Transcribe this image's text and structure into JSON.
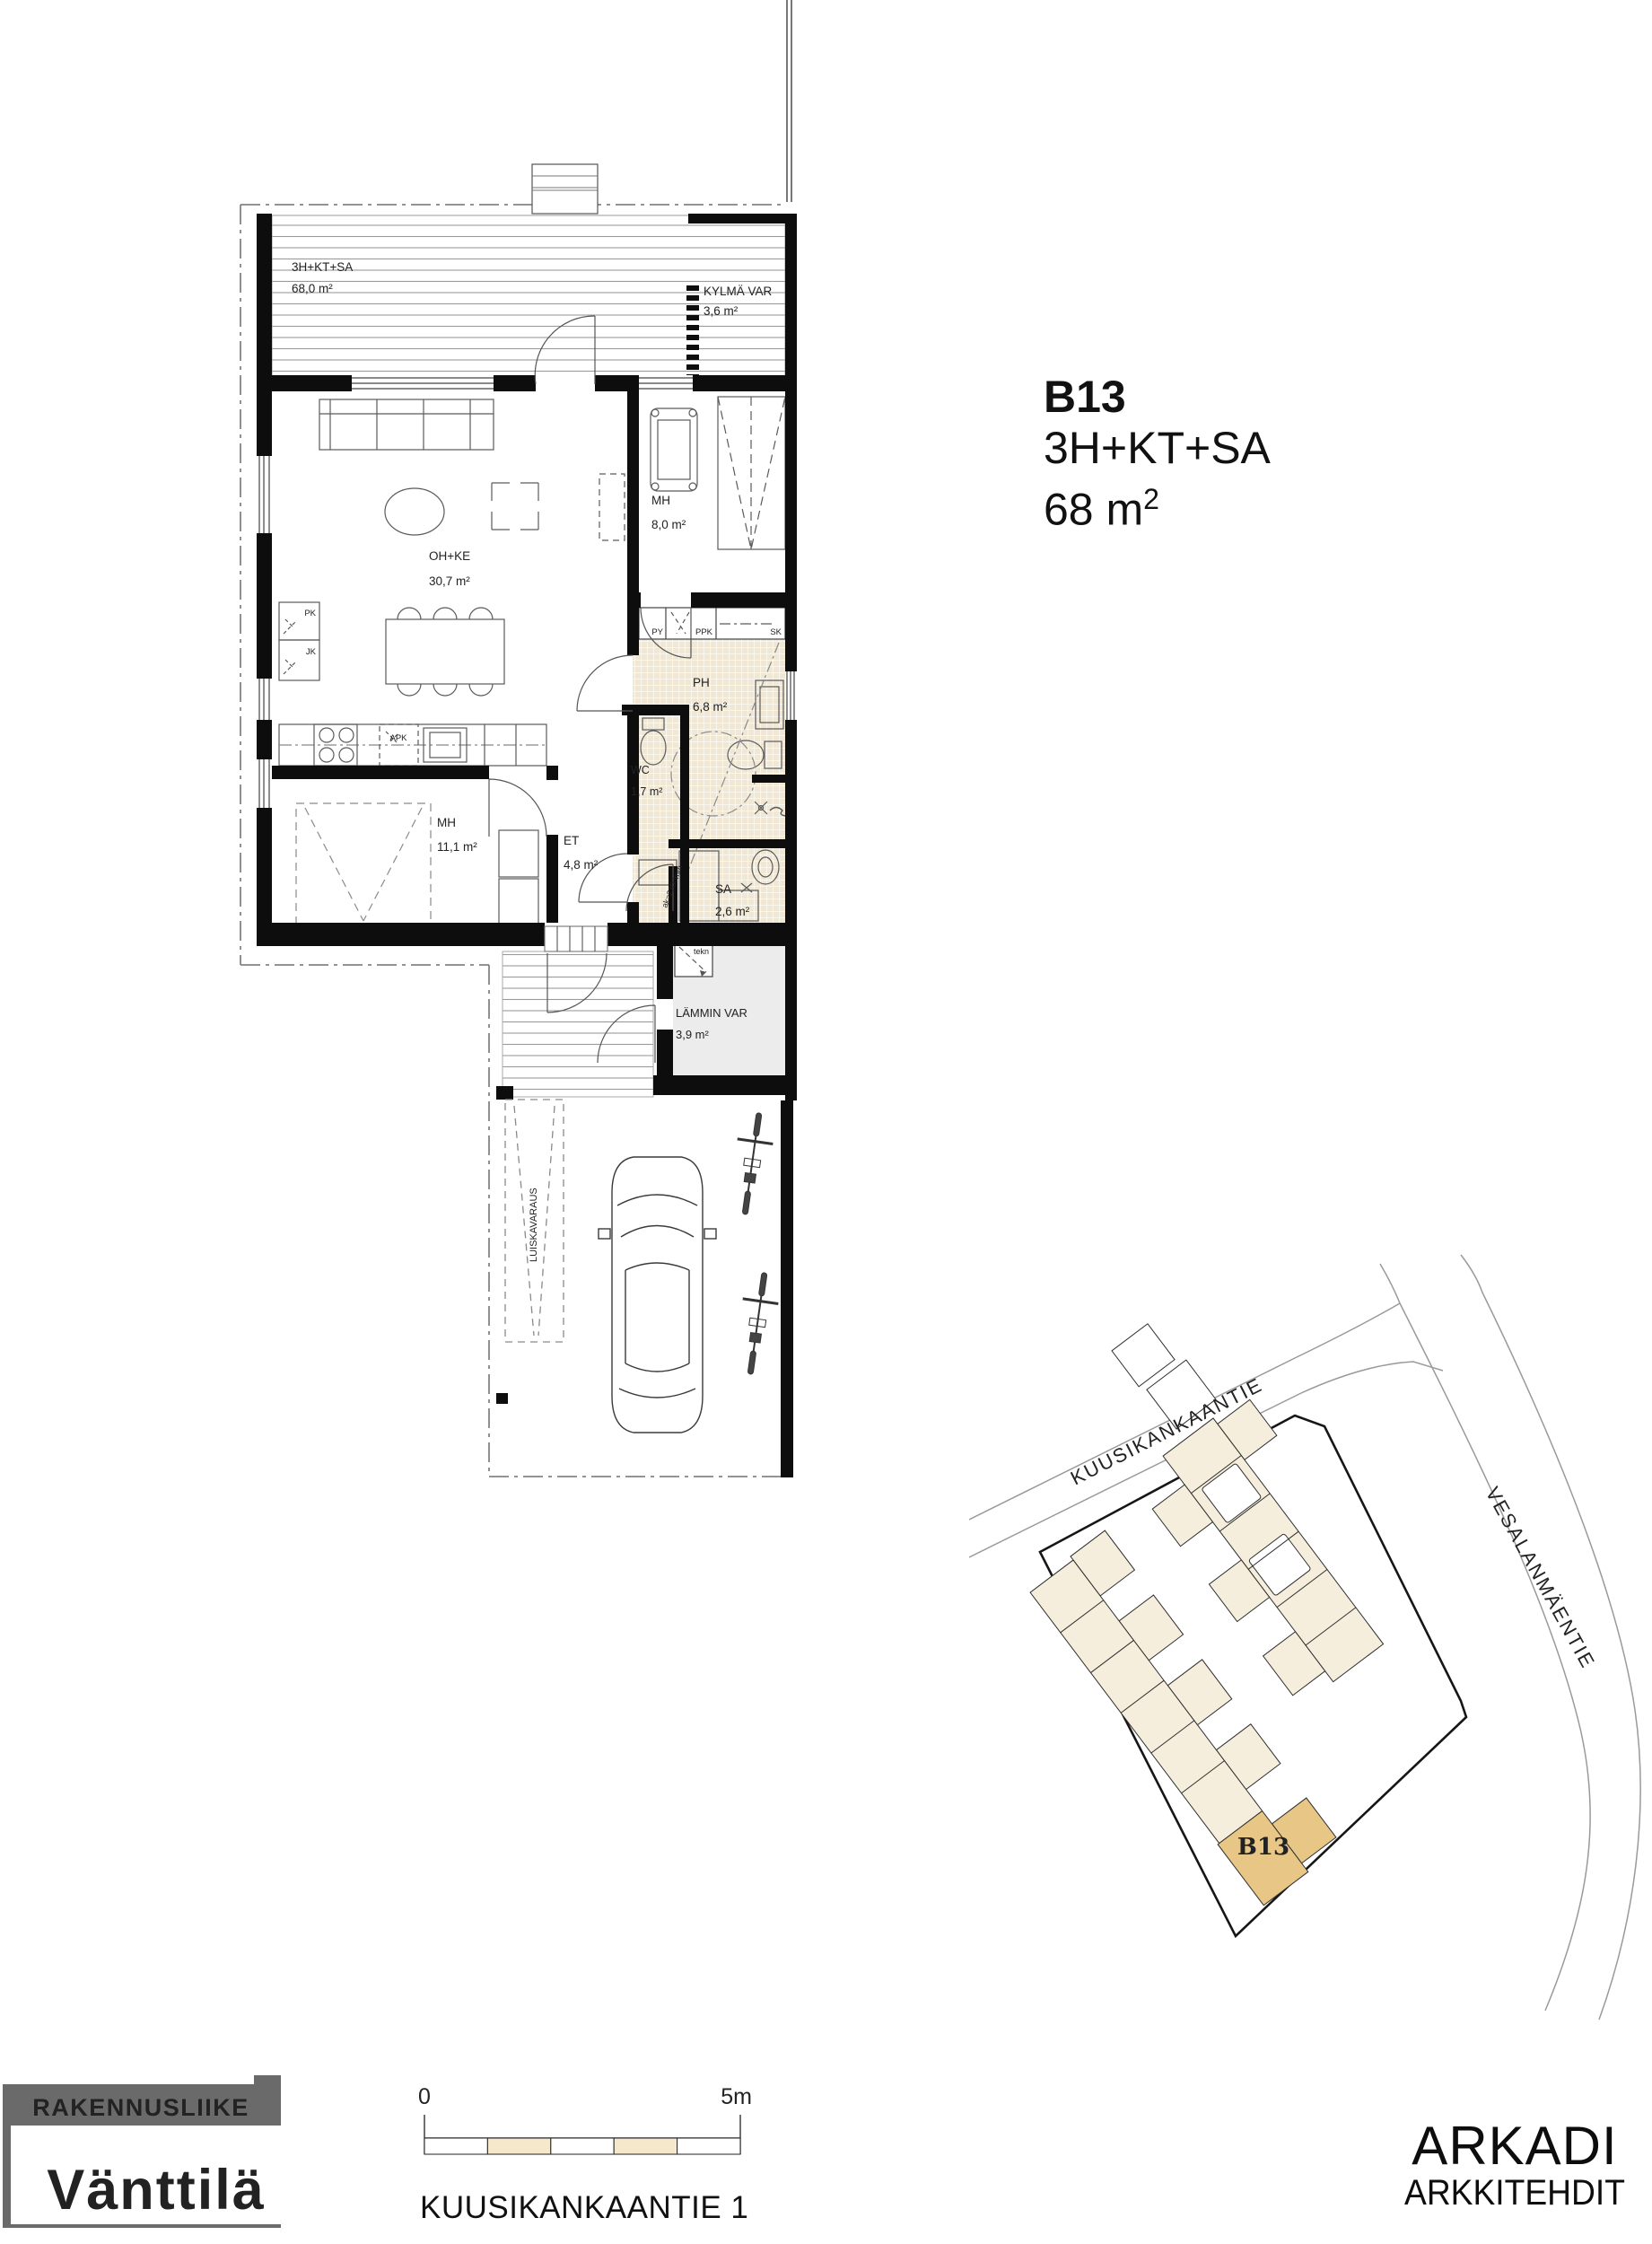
{
  "title": {
    "unit": "B13",
    "type": "3H+KT+SA",
    "area_value": "68 m",
    "area_sup": "2"
  },
  "floor_plan": {
    "terrace": {
      "type": "3H+KT+SA",
      "area": "68,0 m²"
    },
    "kylma_var": {
      "name": "KYLMÄ VAR",
      "area": "3,6 m²"
    },
    "oh_ke": {
      "name": "OH+KE",
      "area": "30,7 m²"
    },
    "mh1": {
      "name": "MH",
      "area": "8,0 m²"
    },
    "ph": {
      "name": "PH",
      "area": "6,8 m²"
    },
    "wc": {
      "name": "WC",
      "area": "1,7 m²"
    },
    "mh2": {
      "name": "MH",
      "area": "11,1 m²"
    },
    "et": {
      "name": "ET",
      "area": "4,8 m²"
    },
    "sa": {
      "name": "SA",
      "area": "2,6 m²"
    },
    "lammin_var": {
      "name": "LÄMMIN VAR",
      "area": "3,9 m²"
    },
    "small_labels": {
      "py": "PY",
      "ppk": "PPK",
      "sk": "SK",
      "pk": "PK",
      "jk": "JK",
      "apk": "APK",
      "tekn": "tekn",
      "luiskavaraus": "LUISKAVARAUS",
      "sauna_height": "ak=2300mm"
    }
  },
  "site_plan": {
    "street_top": "KUUSIKANKAANTIE",
    "street_right": "VESALANMÄENTIE",
    "unit_label": "B13",
    "colors": {
      "building": "#f6eedd",
      "highlight": "#e8c685",
      "highlight_text": "#a9822e"
    }
  },
  "scale_bar": {
    "zero": "0",
    "five": "5m",
    "fill": "#f5e8cb"
  },
  "address": {
    "text": "KUUSIKANKAANTIE 1"
  },
  "builder_logo": {
    "top": "RAKENNUSLIIKE",
    "name": "Vänttilä",
    "color": "#6a6a6a"
  },
  "architect_logo": {
    "line1": "ARKADI",
    "line2": "ARKKITEHDIT"
  }
}
